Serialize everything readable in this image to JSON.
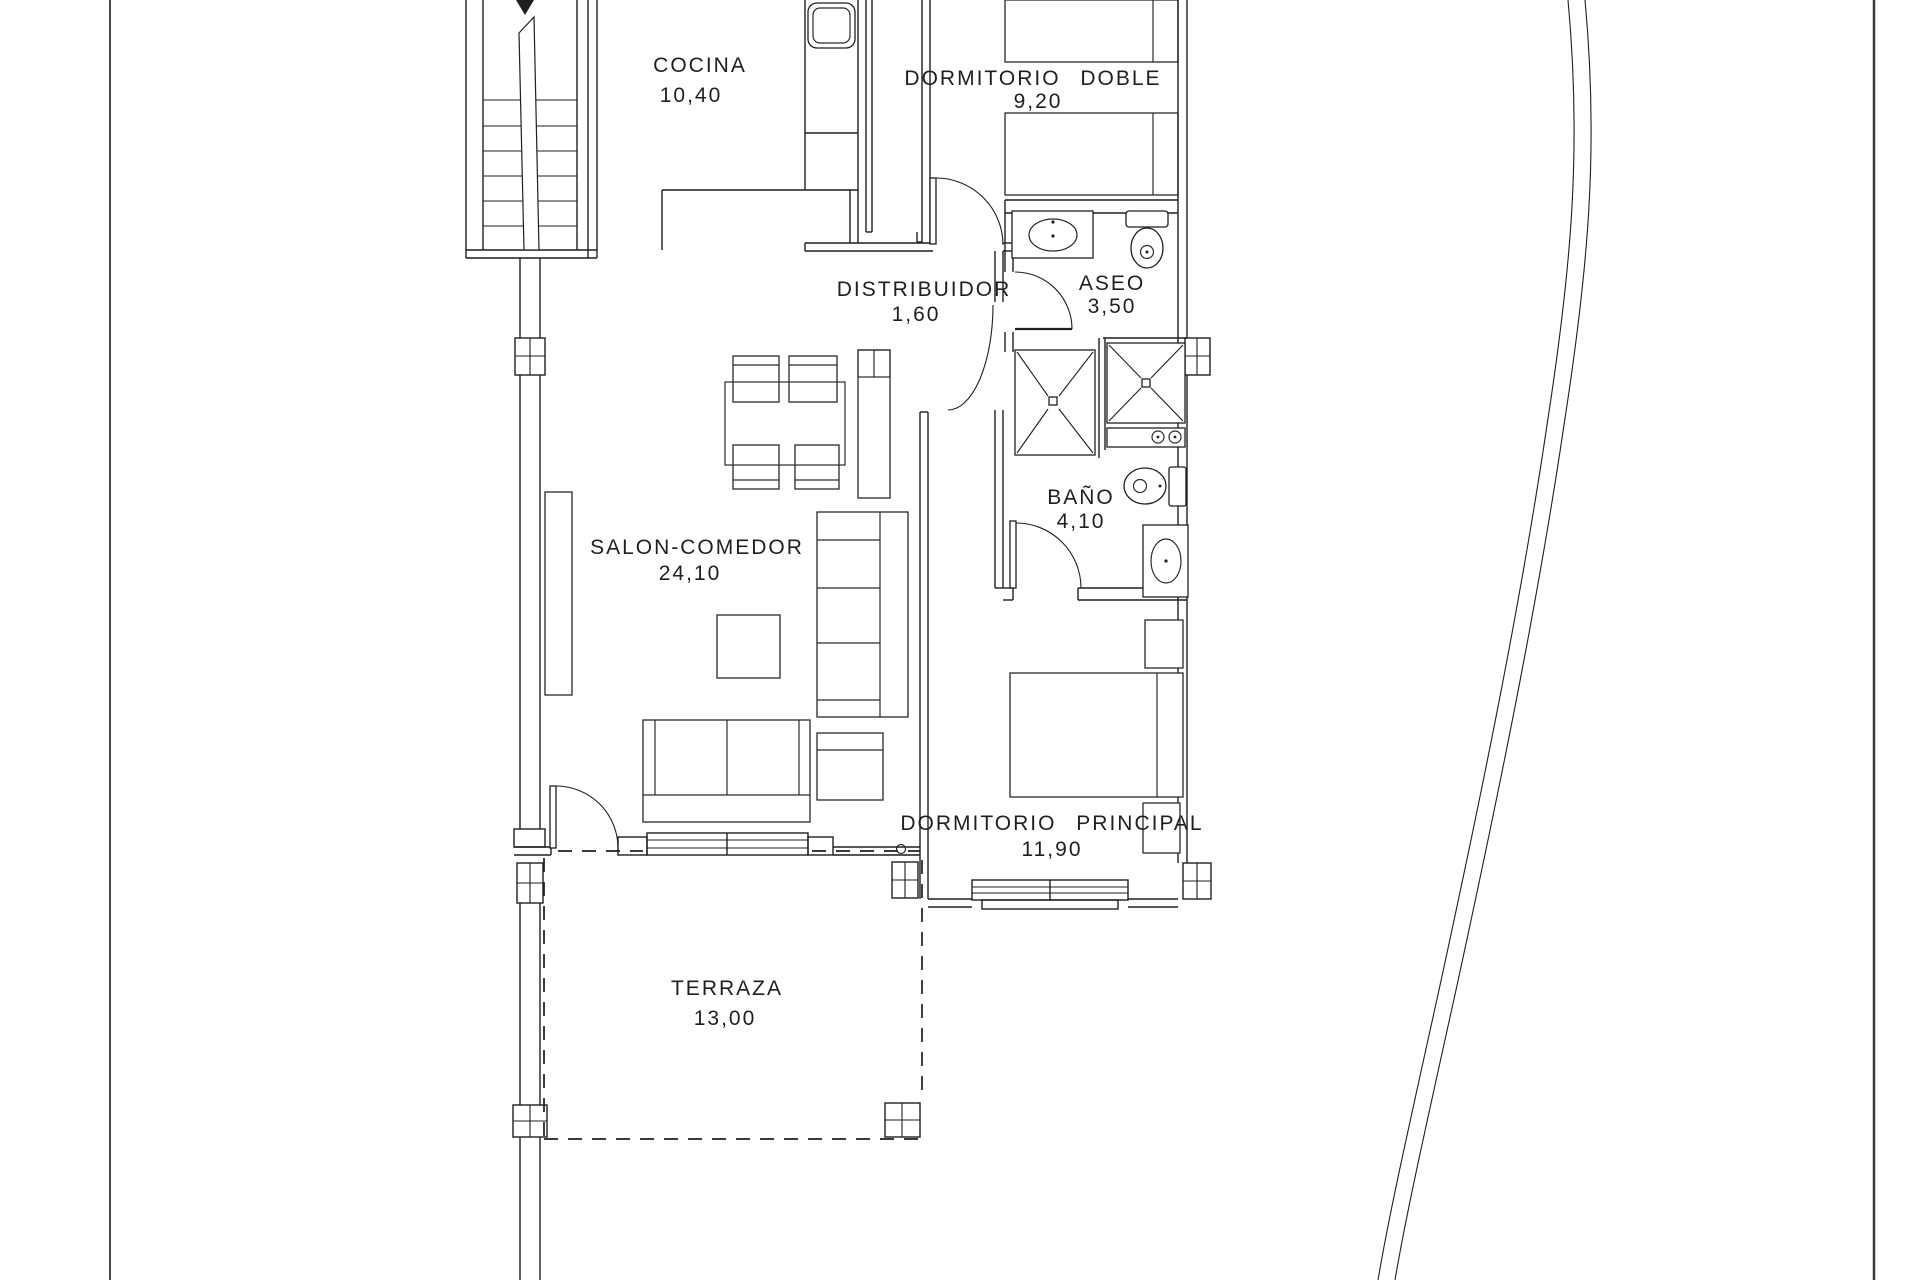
{
  "plan": {
    "rooms": [
      {
        "id": "cocina",
        "name": "COCINA",
        "area": "10,40"
      },
      {
        "id": "dormitorio-doble",
        "name": "DORMITORIO DOBLE",
        "area": "9,20"
      },
      {
        "id": "distribuidor",
        "name": "DISTRIBUIDOR",
        "area": "1,60"
      },
      {
        "id": "aseo",
        "name": "ASEO",
        "area": "3,50"
      },
      {
        "id": "salon-comedor",
        "name": "SALON-COMEDOR",
        "area": "24,10"
      },
      {
        "id": "bano",
        "name": "BAÑO",
        "area": "4,10"
      },
      {
        "id": "dormitorio-principal",
        "name": "DORMITORIO PRINCIPAL",
        "area": "11,90"
      },
      {
        "id": "terraza",
        "name": "TERRAZA",
        "area": "13,00"
      }
    ],
    "colors": {
      "line": "#1f1f1f",
      "border": "#4a4a4a",
      "background": "#ffffff"
    }
  }
}
